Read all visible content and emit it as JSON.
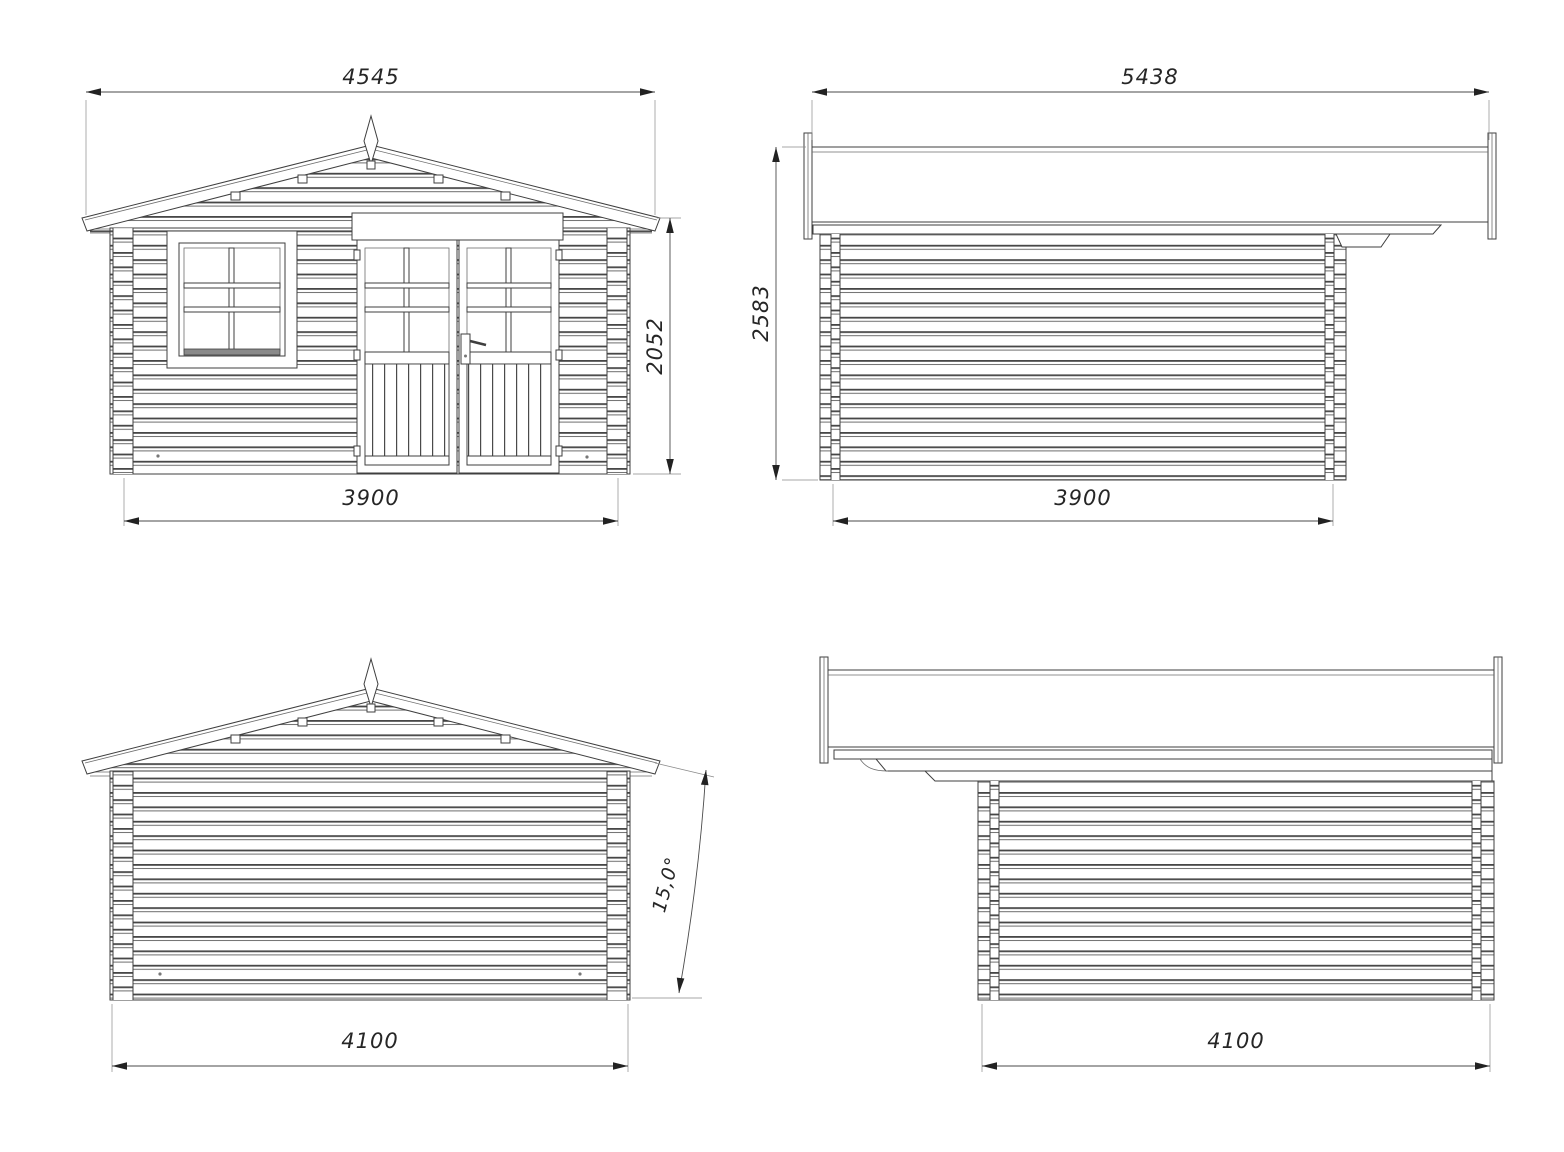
{
  "document": {
    "type": "technical-drawing",
    "subject": "log cabin / garden house elevation views"
  },
  "colors": {
    "line": "#3f3f3f",
    "groove": "#474747",
    "text": "#262626",
    "background": "#ffffff"
  },
  "views": {
    "front": {
      "width_top_mm": "4545",
      "height_right_mm": "2052",
      "width_bottom_mm": "3900"
    },
    "side_a": {
      "width_top_mm": "5438",
      "height_left_mm": "2583",
      "width_bottom_mm": "3900"
    },
    "rear": {
      "width_bottom_mm": "4100",
      "roof_angle": "15,0°"
    },
    "side_b": {
      "width_bottom_mm": "4100"
    }
  }
}
